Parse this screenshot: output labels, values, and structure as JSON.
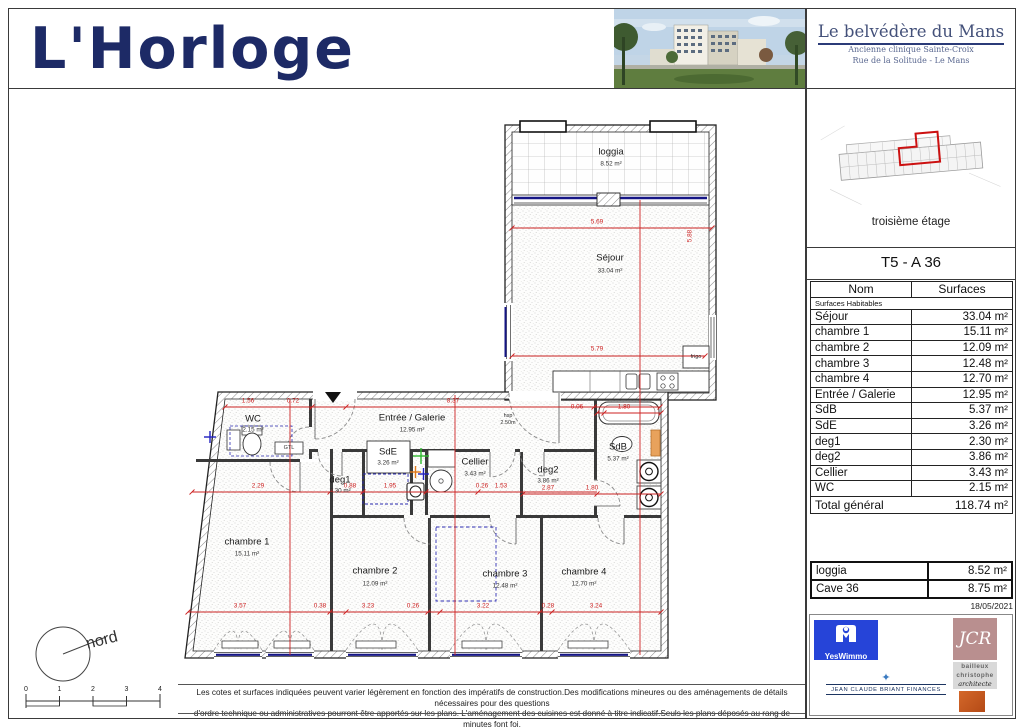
{
  "header": {
    "logo_text": "L'Horloge",
    "project": {
      "title": "Le belvédère du Mans",
      "subtitle1": "Ancienne clinique Sainte-Croix",
      "subtitle2": "Rue de la Solitude - Le Mans"
    }
  },
  "sidebar": {
    "floor_caption": "troisième étage",
    "unit_title": "T5 - A 36",
    "table": {
      "col_name": "Nom",
      "col_surface": "Surfaces",
      "section_label": "Surfaces Habitables",
      "rows": [
        {
          "name": "Séjour",
          "value": "33.04 m²"
        },
        {
          "name": "chambre 1",
          "value": "15.11 m²"
        },
        {
          "name": "chambre 2",
          "value": "12.09 m²"
        },
        {
          "name": "chambre 3",
          "value": "12.48 m²"
        },
        {
          "name": "chambre 4",
          "value": "12.70 m²"
        },
        {
          "name": "Entrée / Galerie",
          "value": "12.95 m²"
        },
        {
          "name": "SdB",
          "value": "5.37 m²"
        },
        {
          "name": "SdE",
          "value": "3.26 m²"
        },
        {
          "name": "deg1",
          "value": "2.30 m²"
        },
        {
          "name": "deg2",
          "value": "3.86 m²"
        },
        {
          "name": "Cellier",
          "value": "3.43 m²"
        },
        {
          "name": "WC",
          "value": "2.15 m²"
        }
      ],
      "total": {
        "name": "Total général",
        "value": "118.74 m²"
      },
      "annex": [
        {
          "name": "loggia",
          "value": "8.52 m²"
        },
        {
          "name": "Cave 36",
          "value": "8.75 m²"
        }
      ]
    },
    "date": "18/05/2021"
  },
  "plan": {
    "rooms": [
      {
        "name": "loggia",
        "area": "8.52 m²"
      },
      {
        "name": "Séjour",
        "area": "33.04 m²"
      },
      {
        "name": "WC",
        "area": "2.15 m²"
      },
      {
        "name": "Entrée / Galerie",
        "area": "12.95 m²"
      },
      {
        "name": "SdE",
        "area": "3.26 m²"
      },
      {
        "name": "deg1",
        "area": "2.30 m²"
      },
      {
        "name": "Cellier",
        "area": "3.43 m²"
      },
      {
        "name": "deg2",
        "area": "3.86 m²"
      },
      {
        "name": "SdB",
        "area": "5.37 m²"
      },
      {
        "name": "chambre 1",
        "area": "15.11 m²"
      },
      {
        "name": "chambre 2",
        "area": "12.09 m²"
      },
      {
        "name": "chambre 3",
        "area": "12.48 m²"
      },
      {
        "name": "chambre 4",
        "area": "12.70 m²"
      }
    ],
    "notes": {
      "hsp_line1": "hsp",
      "hsp_line2": "2.50m",
      "frigo": "frigo",
      "gtl": "GTL"
    },
    "dims": [
      "5.69",
      "5.88",
      "5.79",
      "1.56",
      "0.72",
      "8.37",
      "0.06",
      "1.80",
      "2.29",
      "0.88",
      "1.95",
      "0.26",
      "1.53",
      "2.87",
      "1.80",
      "3.57",
      "0.38",
      "3.23",
      "0.26",
      "3.22",
      "0.28",
      "3.24"
    ]
  },
  "footer": {
    "disclaimer1": "Les cotes et surfaces indiquées peuvent varier légèrement en fonction des impératifs de construction.Des modifications mineures ou des aménagements de détails nécessaires pour des questions",
    "disclaimer2": "d'ordre technique ou administratives pourront être apportés sur les plans. L'aménagement des cuisines est donné à titre indicatif.Seuls les plans déposés au rang de minutes font foi.",
    "north_label": "nord",
    "scale_ticks": [
      "0",
      "1",
      "2",
      "3",
      "4"
    ]
  },
  "logos": {
    "yeswimmo": "YesWimmo",
    "jcr": "JCR",
    "bailleux_line1": "bailleux",
    "bailleux_line2": "christophe",
    "bailleux_line3": "architecte",
    "jcbf": "JEAN CLAUDE BRIANT FINANCES",
    "jcbf_star": "✦"
  }
}
